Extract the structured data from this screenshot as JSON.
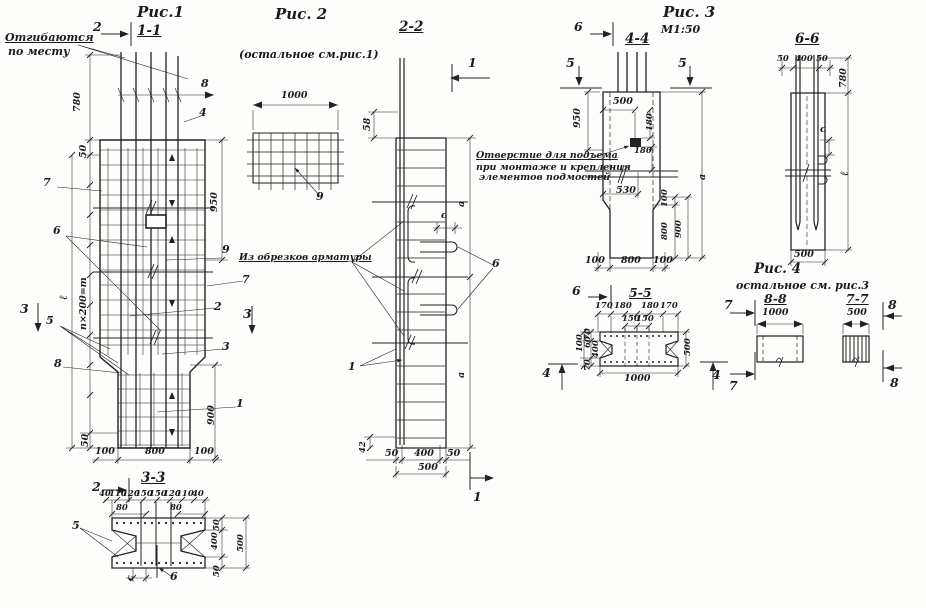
{
  "figures": {
    "fig1": {
      "title": "Рис.1",
      "cut_label": "1-1",
      "note_line1": "Отгибаются",
      "note_line2": "по месту",
      "marker_2_top": "2",
      "marker_2_bottom": "2",
      "marker_3_left": "3",
      "marker_3_right": "3",
      "item_8": "8",
      "item_4": "4",
      "item_7_left": "7",
      "item_6": "6",
      "item_9": "9",
      "item_7_right": "7",
      "item_2": "2",
      "item_3": "3",
      "item_5": "5",
      "item_8_low": "8",
      "item_1": "1",
      "dim_780": "780",
      "dim_50_top": "50",
      "dim_950": "950",
      "dim_length": "ℓ",
      "dim_spacing": "n×200=m",
      "dim_50_bottom": "50",
      "dim_100_left": "100",
      "dim_800": "800",
      "dim_100_right": "100",
      "dim_900": "900",
      "sec33": {
        "title": "3-3",
        "top_dims": [
          "40",
          "110",
          "120",
          "150",
          "150",
          "120",
          "110",
          "40"
        ],
        "dim_80_left": "80",
        "dim_80_right": "80",
        "dim_50_a": "50",
        "dim_400": "400",
        "dim_500": "500",
        "dim_50_b": "50",
        "item_5": "5",
        "dim_c": "с",
        "item_6": "6"
      }
    },
    "fig2": {
      "title": "Рис. 2",
      "note": "(остальное см.рис.1)",
      "dim_1000": "1000",
      "item_9": "9"
    },
    "sec22": {
      "title": "2-2",
      "marker_1_top": "1",
      "marker_1_bottom": "1",
      "note": "Из обрезков арматуры",
      "dim_58": "58",
      "dim_a_top": "а",
      "dim_c": "с",
      "item_6": "6",
      "item_1": "1",
      "dim_a_bottom": "а",
      "dim_42": "42",
      "dim_50_left": "50",
      "dim_400": "400",
      "dim_50_right": "50",
      "dim_500": "500"
    },
    "fig3": {
      "title": "Рис. 3",
      "scale": "М1:50"
    },
    "sec44": {
      "title": "4-4",
      "marker_6_top": "6",
      "marker_5_left": "5",
      "marker_5_right": "5",
      "marker_6_bottom": "6",
      "note_line1": "Отверстие для подъема",
      "note_line2": "при монтаже и крепления",
      "note_line3": "элементов подмостей",
      "dim_950": "950",
      "dim_500": "500",
      "dim_180_a": "180",
      "dim_180_b": "180",
      "dim_530": "530",
      "dim_100_v": "100",
      "dim_800_v": "800",
      "dim_900_v": "900",
      "dim_a": "а",
      "dim_100_left": "100",
      "dim_800_bottom": "800",
      "dim_100_right": "100"
    },
    "sec55": {
      "title": "5-5",
      "top_dims": [
        "170",
        "180",
        "180",
        "170"
      ],
      "mid_dims": [
        "150",
        "150"
      ],
      "left_dims": [
        "70",
        "100",
        "60",
        "400",
        "70"
      ],
      "dim_500": "500",
      "dim_1000": "1000",
      "marker_4_left": "4",
      "marker_4_right": "4"
    },
    "fig4": {
      "title": "Рис. 4",
      "note": "остальное см. рис.3"
    },
    "sec88": {
      "title": "8-8",
      "dim_1000": "1000",
      "marker_7_top": "7",
      "marker_7_bottom": "7"
    },
    "sec77": {
      "title": "7-7",
      "dim_500": "500",
      "marker_8_top": "8",
      "marker_8_bottom": "8"
    },
    "sec66": {
      "title": "6-6",
      "dim_50_left": "50",
      "dim_400": "400",
      "dim_50_right": "50",
      "dim_780": "780",
      "dim_c": "с",
      "dim_length": "ℓ",
      "dim_500": "500"
    }
  },
  "colors": {
    "ink": "#1c1c1c",
    "paper": "#fdfdfb"
  }
}
